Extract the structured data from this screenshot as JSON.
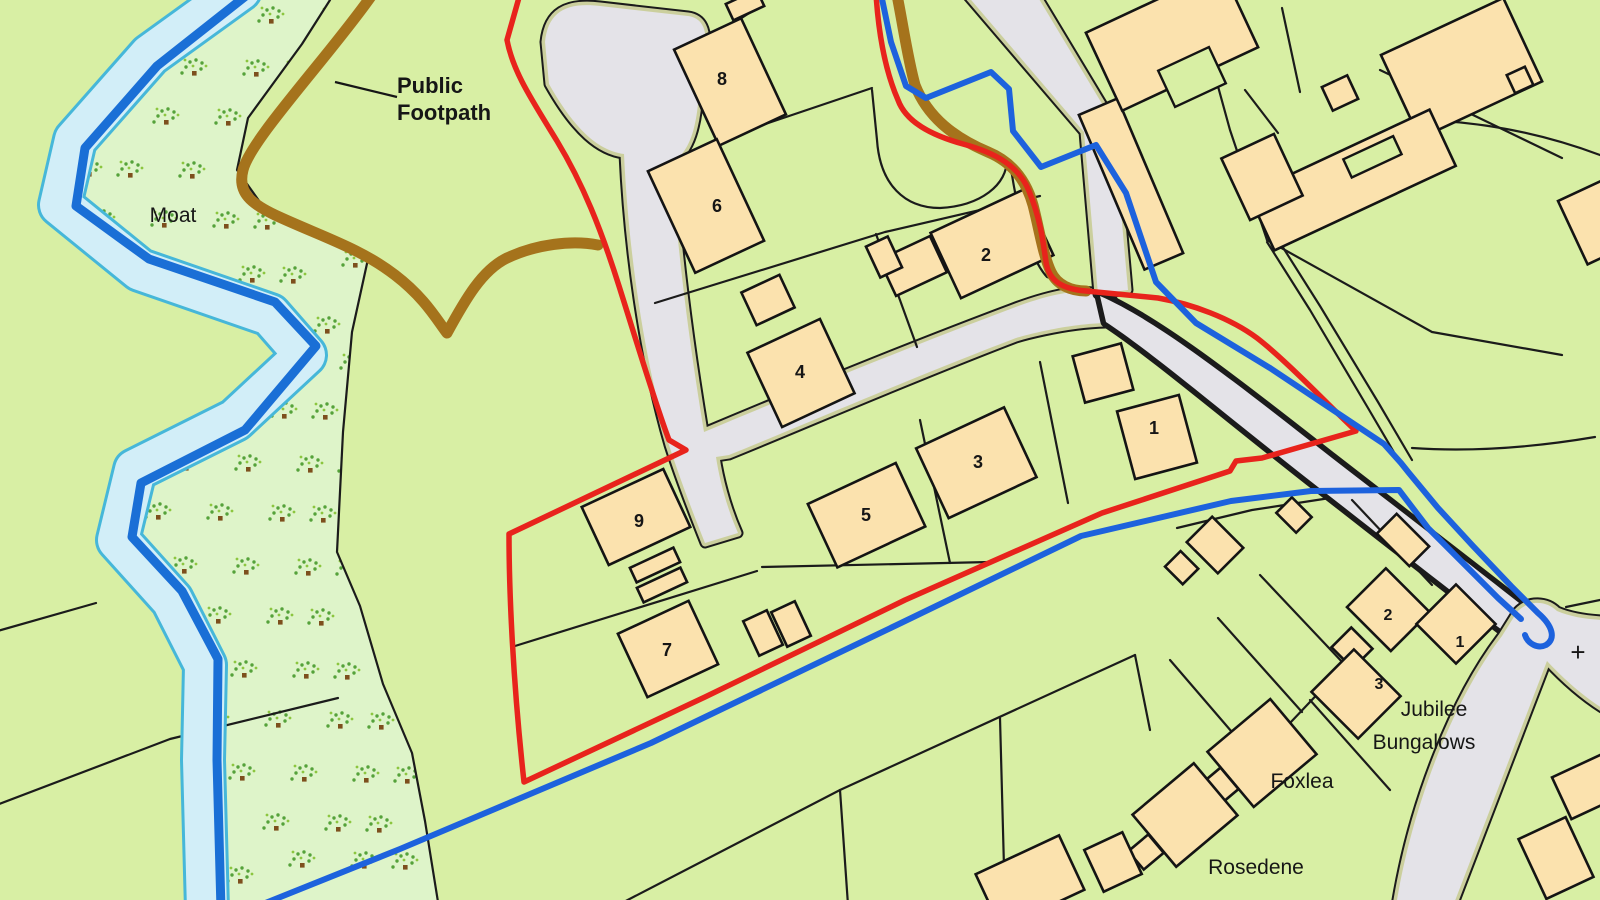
{
  "map": {
    "title": "Site location plan",
    "colors": {
      "field": "#d8efa4",
      "scrub": "#def4c9",
      "water-pale": "#d2eef8",
      "water-dark": "#1a6fd6",
      "water-cyan": "#46b7d9",
      "road": "#e4e3e8",
      "verge": "#cbcf9d",
      "building": "#fbe2ae",
      "boundary-red": "#e8231c",
      "boundary-blue": "#1d62dd",
      "footpath-brown": "#a5731c",
      "line-black": "#1b1b1b"
    },
    "legend_semantics": {
      "red-line": "application site boundary",
      "blue-line": "additional land boundary",
      "brown-line": "public footpath route"
    },
    "labels": [
      {
        "name": "moat-label",
        "text": "Moat",
        "x": 173,
        "y": 222,
        "size": 21,
        "weight": 400,
        "anchor": "middle"
      },
      {
        "name": "public-footpath-label-line1",
        "text": "Public",
        "x": 397,
        "y": 93,
        "size": 22,
        "weight": 700,
        "anchor": "start"
      },
      {
        "name": "public-footpath-label-line2",
        "text": "Footpath",
        "x": 397,
        "y": 120,
        "size": 22,
        "weight": 700,
        "anchor": "start"
      },
      {
        "name": "jubilee-bungalows-label-line1",
        "text": "Jubilee",
        "x": 1434,
        "y": 716,
        "size": 21,
        "weight": 400,
        "anchor": "middle"
      },
      {
        "name": "jubilee-bungalows-label-line2",
        "text": "Bungalows",
        "x": 1424,
        "y": 749,
        "size": 21,
        "weight": 400,
        "anchor": "middle"
      },
      {
        "name": "foxlea-label",
        "text": "Foxlea",
        "x": 1302,
        "y": 788,
        "size": 21,
        "weight": 400,
        "anchor": "middle"
      },
      {
        "name": "rosedene-label",
        "text": "Rosedene",
        "x": 1256,
        "y": 874,
        "size": 21,
        "weight": 400,
        "anchor": "middle"
      },
      {
        "name": "grid-cross-mark",
        "text": "+",
        "x": 1578,
        "y": 661,
        "size": 26,
        "weight": 400,
        "anchor": "middle"
      }
    ],
    "building_numbers": [
      {
        "name": "building-8-number",
        "text": "8",
        "x": 722,
        "y": 85
      },
      {
        "name": "building-6-number",
        "text": "6",
        "x": 717,
        "y": 212
      },
      {
        "name": "building-4-number",
        "text": "4",
        "x": 800,
        "y": 378
      },
      {
        "name": "building-2-number",
        "text": "2",
        "x": 986,
        "y": 261
      },
      {
        "name": "building-1-number",
        "text": "1",
        "x": 1154,
        "y": 434
      },
      {
        "name": "building-3-number",
        "text": "3",
        "x": 978,
        "y": 468
      },
      {
        "name": "building-5-number",
        "text": "5",
        "x": 866,
        "y": 521
      },
      {
        "name": "building-9-number",
        "text": "9",
        "x": 639,
        "y": 527
      },
      {
        "name": "building-7-number",
        "text": "7",
        "x": 667,
        "y": 656
      }
    ],
    "bungalow_numbers": [
      {
        "name": "bungalow-2-number",
        "text": "2",
        "x": 1388,
        "y": 620
      },
      {
        "name": "bungalow-1-number",
        "text": "1",
        "x": 1460,
        "y": 647
      },
      {
        "name": "bungalow-3-number",
        "text": "3",
        "x": 1379,
        "y": 689
      }
    ]
  }
}
